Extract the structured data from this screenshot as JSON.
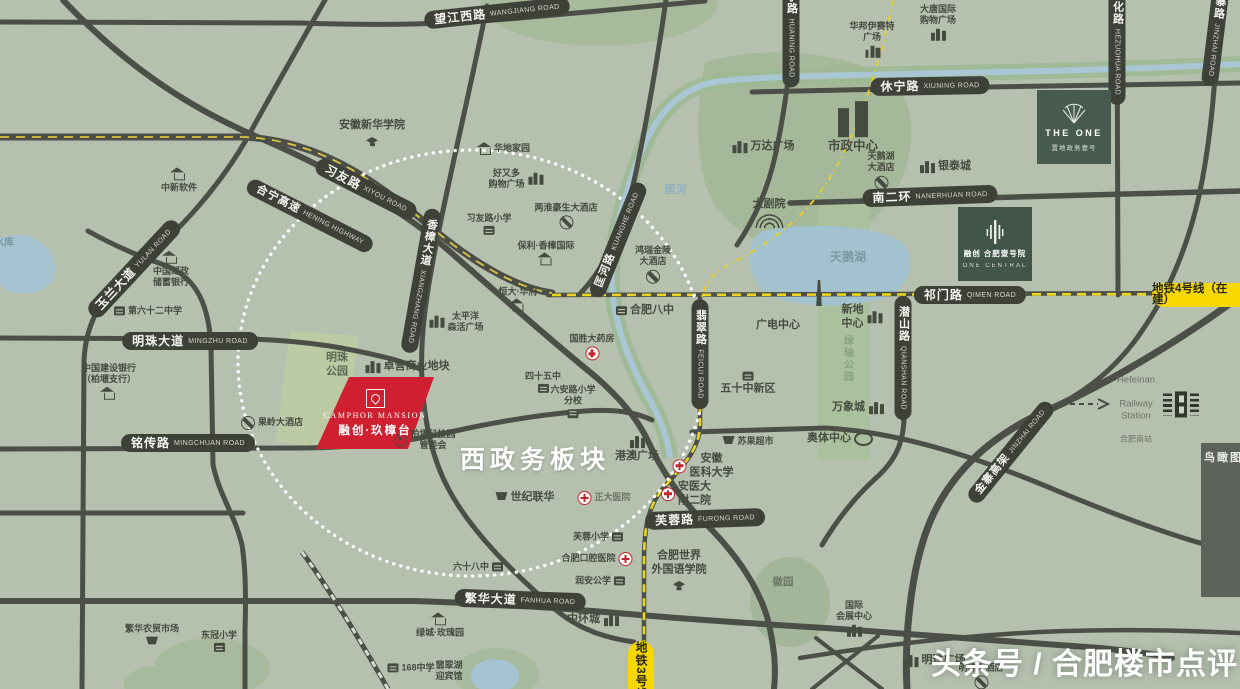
{
  "labels": {
    "region": "西政务板块",
    "watermark": "头条号 / 合肥楼市点评",
    "inset": "鸟瞰图",
    "kuanghe_river": "匡河",
    "swan_lake": "天鹅湖",
    "reservoir": "水库",
    "mingzhu_park": "明珠\n公园",
    "green_axis_park": "绿轴公园",
    "hui_garden": "徽园"
  },
  "roads": {
    "wangjiang": {
      "zh": "望江西路",
      "en": "WANGJIANG ROAD"
    },
    "xiyou": {
      "zh": "习友路",
      "en": "XIYOU ROAD"
    },
    "hening": {
      "zh": "合宁高速",
      "en": "HENING HIGHWAY"
    },
    "kuanghe": {
      "zh": "匡河路",
      "en": "KUANGHE ROAD"
    },
    "xiangzhang": {
      "zh": "香樟大道",
      "en": "XIANGZHANG ROAD"
    },
    "yulan": {
      "zh": "玉兰大道",
      "en": "YULAN ROAD"
    },
    "mingzhu": {
      "zh": "明珠大道",
      "en": "MINGZHU ROAD"
    },
    "mingchuan": {
      "zh": "铭传路",
      "en": "MINGCHUAN ROAD"
    },
    "huaining": {
      "zh": "怀宁路",
      "en": "HUANING ROAD"
    },
    "hezuohua": {
      "zh": "合作化路",
      "en": "HEZUOHUA ROAD"
    },
    "jinzhai": {
      "zh": "金寨路",
      "en": "JINZHAI ROAD"
    },
    "xiuning": {
      "zh": "休宁路",
      "en": "XIUNING ROAD"
    },
    "nanerhuan": {
      "zh": "南二环",
      "en": "NANERHUAN ROAD"
    },
    "qimen": {
      "zh": "祁门路",
      "en": "QIMEN ROAD"
    },
    "qianshan": {
      "zh": "潜山路",
      "en": "QIANSHAN ROAD"
    },
    "feicui": {
      "zh": "翡翠路",
      "en": "FEICUI ROAD"
    },
    "furong": {
      "zh": "芙蓉路",
      "en": "FURONG ROAD"
    },
    "fanhua": {
      "zh": "繁华大道",
      "en": "FANHUA ROAD"
    },
    "jinzhai_viaduct": {
      "zh": "金寨高架",
      "en": "JINZHAI ROAD"
    }
  },
  "metro": {
    "line3": "地铁3号线",
    "line4": "地铁4号线（在建）"
  },
  "projects": {
    "camphor": {
      "brand": "CAMPHOR MANSION",
      "name": "融创·玖樟台"
    },
    "the_one": {
      "brand": "THE ONE",
      "name": "置地政务壹号"
    },
    "one_central": {
      "name": "融创 合肥壹号院",
      "brand": "ONE CENTRAL"
    }
  },
  "station": {
    "en1": "Hefeinan",
    "en2": "Railway Station",
    "zh": "合肥南站"
  },
  "pois": {
    "zhongxin": {
      "label": "中新软件"
    },
    "xinhua": {
      "label": "安徽新华学院"
    },
    "huadi": {
      "label": "华地家园"
    },
    "haoyouduo": {
      "label": "好又多\n购物广场"
    },
    "xiyou_primary": {
      "label": "习友路小学"
    },
    "haosheng": {
      "label": "两淮豪生大酒店"
    },
    "baoli": {
      "label": "保利·香樟国际"
    },
    "hengda": {
      "label": "恒大·华府"
    },
    "pacific": {
      "label": "太平洋\n森活广场"
    },
    "postal": {
      "label": "中国邮政\n储蓄银行"
    },
    "school62": {
      "label": "第六十二中学"
    },
    "ccb": {
      "label": "中国建设银行\n（柏堰支行）"
    },
    "zhuoying": {
      "label": "卓营商业地块"
    },
    "baiyan": {
      "label": "柏堰科技园\n管委会"
    },
    "guoling": {
      "label": "果岭大酒店"
    },
    "guosheng": {
      "label": "国胜大药房"
    },
    "bazhong": {
      "label": "合肥八中"
    },
    "hongrui": {
      "label": "鸿瑞金陵\n大酒店"
    },
    "fifty_new": {
      "label": "五十中新区"
    },
    "guangdian": {
      "label": "广电中心"
    },
    "theater": {
      "label": "大剧院"
    },
    "wanda": {
      "label": "万达广场"
    },
    "shizheng": {
      "label": "市政中心"
    },
    "swan_hotel": {
      "label": "天鹅湖\n大酒店"
    },
    "yintai": {
      "label": "银泰城"
    },
    "datang": {
      "label": "大唐国际\n购物广场"
    },
    "huabang": {
      "label": "华邦伊赛特\n广场"
    },
    "xindi": {
      "label": "新地\n中心"
    },
    "wanxiang": {
      "label": "万象城"
    },
    "aoti": {
      "label": "奥体中心"
    },
    "suguo": {
      "label": "苏果超市"
    },
    "gangao": {
      "label": "港澳广场"
    },
    "anyida": {
      "label": "安徽\n医科大学"
    },
    "fueryuan": {
      "label": "安医大\n附二院"
    },
    "shiji": {
      "label": "世纪联华"
    },
    "zhengda": {
      "label": "正大医院"
    },
    "furong_pri": {
      "label": "芙蓉小学"
    },
    "kouqiang": {
      "label": "合肥口腔医院"
    },
    "runan": {
      "label": "润安公学"
    },
    "waiguoyu": {
      "label": "合肥世界\n外国语学院"
    },
    "zhonghuan": {
      "label": "中环城"
    },
    "lvcheng": {
      "label": "绿城·玫瑰园"
    },
    "school68": {
      "label": "六十八中"
    },
    "school168": {
      "label": "168中学"
    },
    "feicui_hotel": {
      "label": "翡翠湖\n迎宾馆"
    },
    "fanhua_market": {
      "label": "繁华农贸市场"
    },
    "dongguan": {
      "label": "东冠小学"
    },
    "exhibition": {
      "label": "国际\n会展中心"
    },
    "mingzhu_plaza": {
      "label": "明珠广场"
    },
    "mingzhu_hotel": {
      "label": "明珠大酒店"
    },
    "s45": {
      "label": "四十五中"
    },
    "luan_branch": {
      "label": "六安路小学\n分校"
    }
  }
}
